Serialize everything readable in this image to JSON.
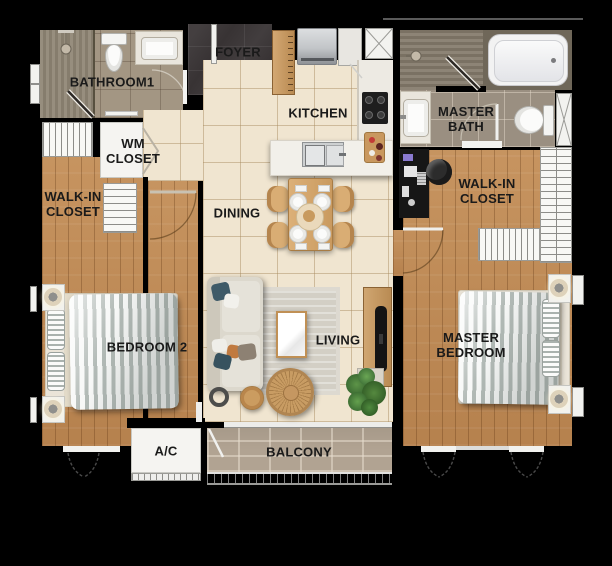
{
  "title": "Two-bedroom apartment floor plan",
  "rooms": {
    "bathroom1": {
      "label": "BATHROOM1"
    },
    "foyer": {
      "label": "FOYER"
    },
    "kitchen": {
      "label": "KITCHEN"
    },
    "master_bath": {
      "label": "MASTER\nBATH"
    },
    "wm_closet": {
      "label": "WM\nCLOSET"
    },
    "walk_in_closet_left": {
      "label": "WALK-IN\nCLOSET"
    },
    "walk_in_closet_right": {
      "label": "WALK-IN\nCLOSET"
    },
    "dining": {
      "label": "DINING"
    },
    "living": {
      "label": "LIVING"
    },
    "bedroom2": {
      "label": "BEDROOM 2"
    },
    "master_bedroom": {
      "label": "MASTER\nBEDROOM"
    },
    "ac": {
      "label": "A/C"
    },
    "balcony": {
      "label": "BALCONY"
    }
  },
  "colors": {
    "background": "#000000",
    "wood_floor": "#c08a54",
    "tile_floor": "#f0e5d0",
    "foyer_tile": "#383334",
    "bath_tile": "#a39683",
    "balcony_tile": "#b1a392",
    "fixture_white": "#f5f4f1",
    "label_text": "#1a1a1a"
  }
}
